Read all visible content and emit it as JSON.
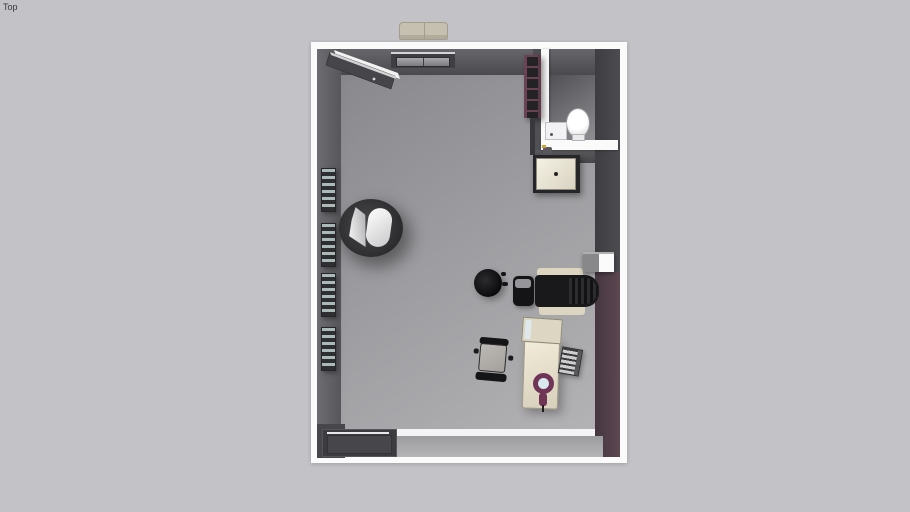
{
  "app": {
    "view_label": "Top"
  },
  "viewport": {
    "background": "#c3c3c7"
  },
  "palette": {
    "wall_cap_white": "#fbfbfc",
    "wall_face_dark": "#4c4c50",
    "wall_face_maroon": "#4e3b45",
    "floor_main": "#9c9ca0",
    "floor_bathroom": "#6f6f73",
    "furniture_cream": "#dcd5bf",
    "furniture_black": "#19191b",
    "magnifier_accent": "#6f3456",
    "radiator_slat": "#a9bab8",
    "bench_tan": "#c6c0b1"
  },
  "scene": {
    "description": "Top-down 3D view of a furnished treatment room with en-suite bathroom",
    "objects": {
      "room": "Room shell",
      "floor": "Room floor",
      "wall": "Wall",
      "entry_door": "Open entry door",
      "ceiling_vent": "Ceiling vent",
      "bench": "Exterior bench",
      "bathroom": "Bathroom",
      "toilet": "Toilet",
      "washbasin": "Bathroom washbasin",
      "wall_shelf": "Wall shelf unit",
      "vanity": "Sink vanity",
      "faucet": "Faucet",
      "radiator": "Wall radiator",
      "armchair": "Tub armchair",
      "stool": "Round stool",
      "treatment_chair": "Treatment chair",
      "clinician_stool": "Clinician stool",
      "pass_through": "Pass-through window",
      "desk": "Desk",
      "desk_hutch": "Desk hutch",
      "magnifier": "Magnifier lamp",
      "keyboard_tray": "Keyboard tray",
      "office_chair": "Office chair",
      "sliding_door": "Sliding door",
      "threshold": "Door threshold"
    }
  }
}
